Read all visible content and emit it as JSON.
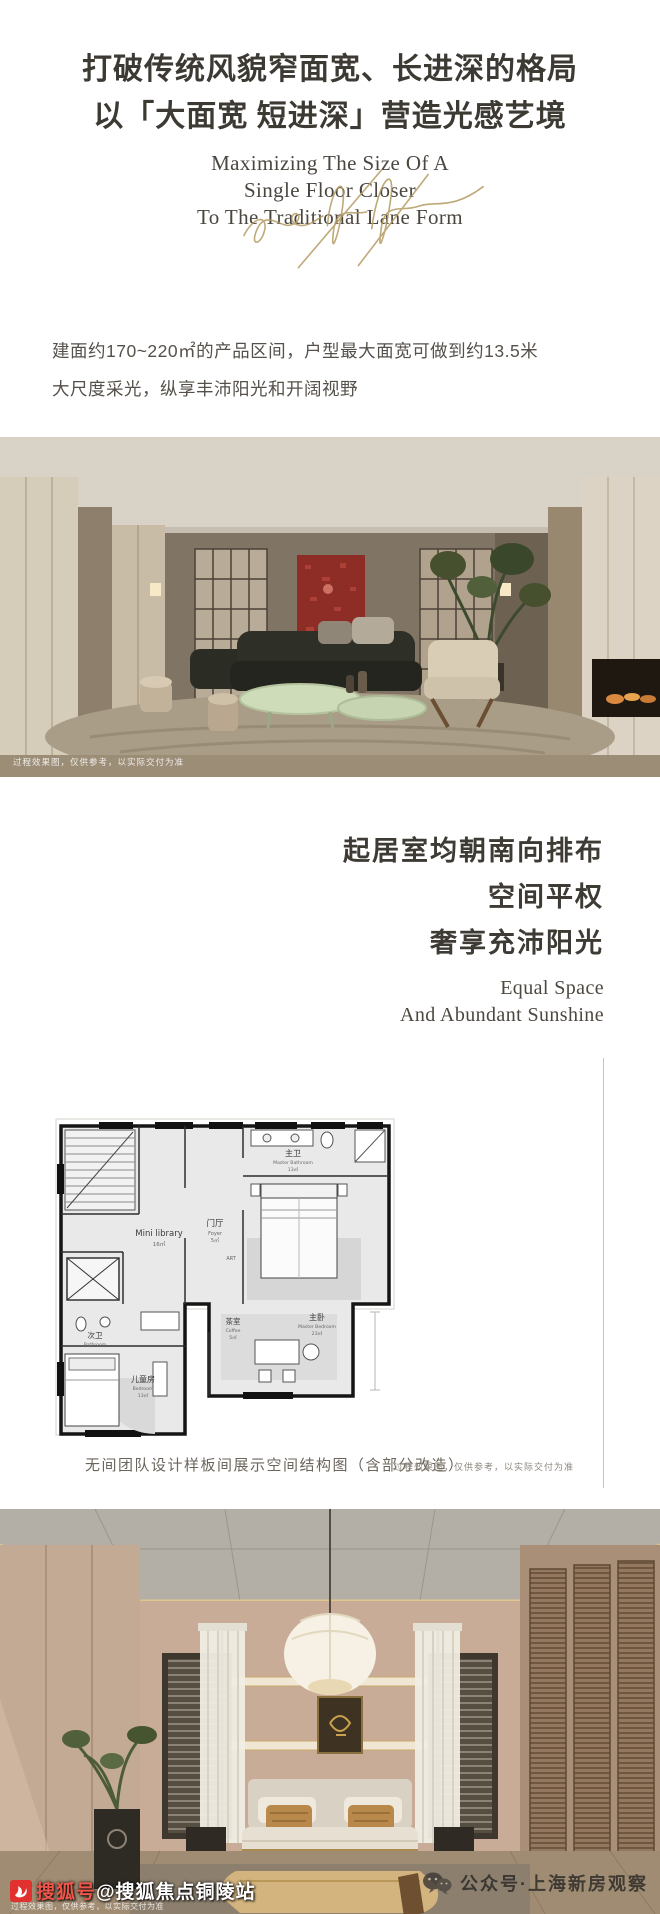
{
  "hero": {
    "headline1": "打破传统风貌窄面宽、长进深的格局",
    "headline2": "以「大面宽 短进深」营造光感艺境",
    "sub": [
      "Maximizing The Size Of A",
      "Single Floor Closer",
      "To The Traditional Lane Form"
    ],
    "accent_gold": "#b39a62"
  },
  "intro": {
    "line1": "建面约170~220㎡的产品区间，户型最大面宽可做到约13.5米",
    "line2": "大尺度采光，纵享丰沛阳光和开阔视野"
  },
  "living": {
    "caption": "过程效果图，仅供参考，以实际交付为准"
  },
  "section2": {
    "cn": [
      "起居室均朝南向排布",
      "空间平权",
      "奢享充沛阳光"
    ],
    "en": [
      "Equal Space",
      "And Abundant Sunshine"
    ]
  },
  "floorplan": {
    "labels": {
      "mini": {
        "name": "Mini library",
        "area": "16㎡"
      },
      "foyer": {
        "cn": "门厅",
        "en": "Foyer",
        "area": "5㎡"
      },
      "master_bath": {
        "cn": "主卫",
        "en": "Master Bathroom",
        "area": "13㎡"
      },
      "master_bed": {
        "cn": "主卧",
        "en": "Master Bedroom",
        "area": "23㎡"
      },
      "tea": {
        "cn": "茶室",
        "en": "Coffee",
        "area": "5㎡"
      },
      "second_bath": {
        "cn": "次卫",
        "en": "Bathroom"
      },
      "kids": {
        "cn": "儿童房",
        "en": "Bedroom",
        "area": "13㎡"
      },
      "art": "ART"
    },
    "caption_left": "无间团队设计样板间展示空间结构图（含部分改造）",
    "caption_right": "过程效果图，仅供参考，以实际交付为准"
  },
  "bedroom": {
    "caption": "过程效果图，仅供参考，以实际交付为准"
  },
  "watermarks": {
    "sohu_prefix": "搜狐号",
    "sohu_suffix": "@搜狐焦点铜陵站",
    "sohu_red": "#e0312e",
    "wechat": "公众号·上海新房观察"
  }
}
